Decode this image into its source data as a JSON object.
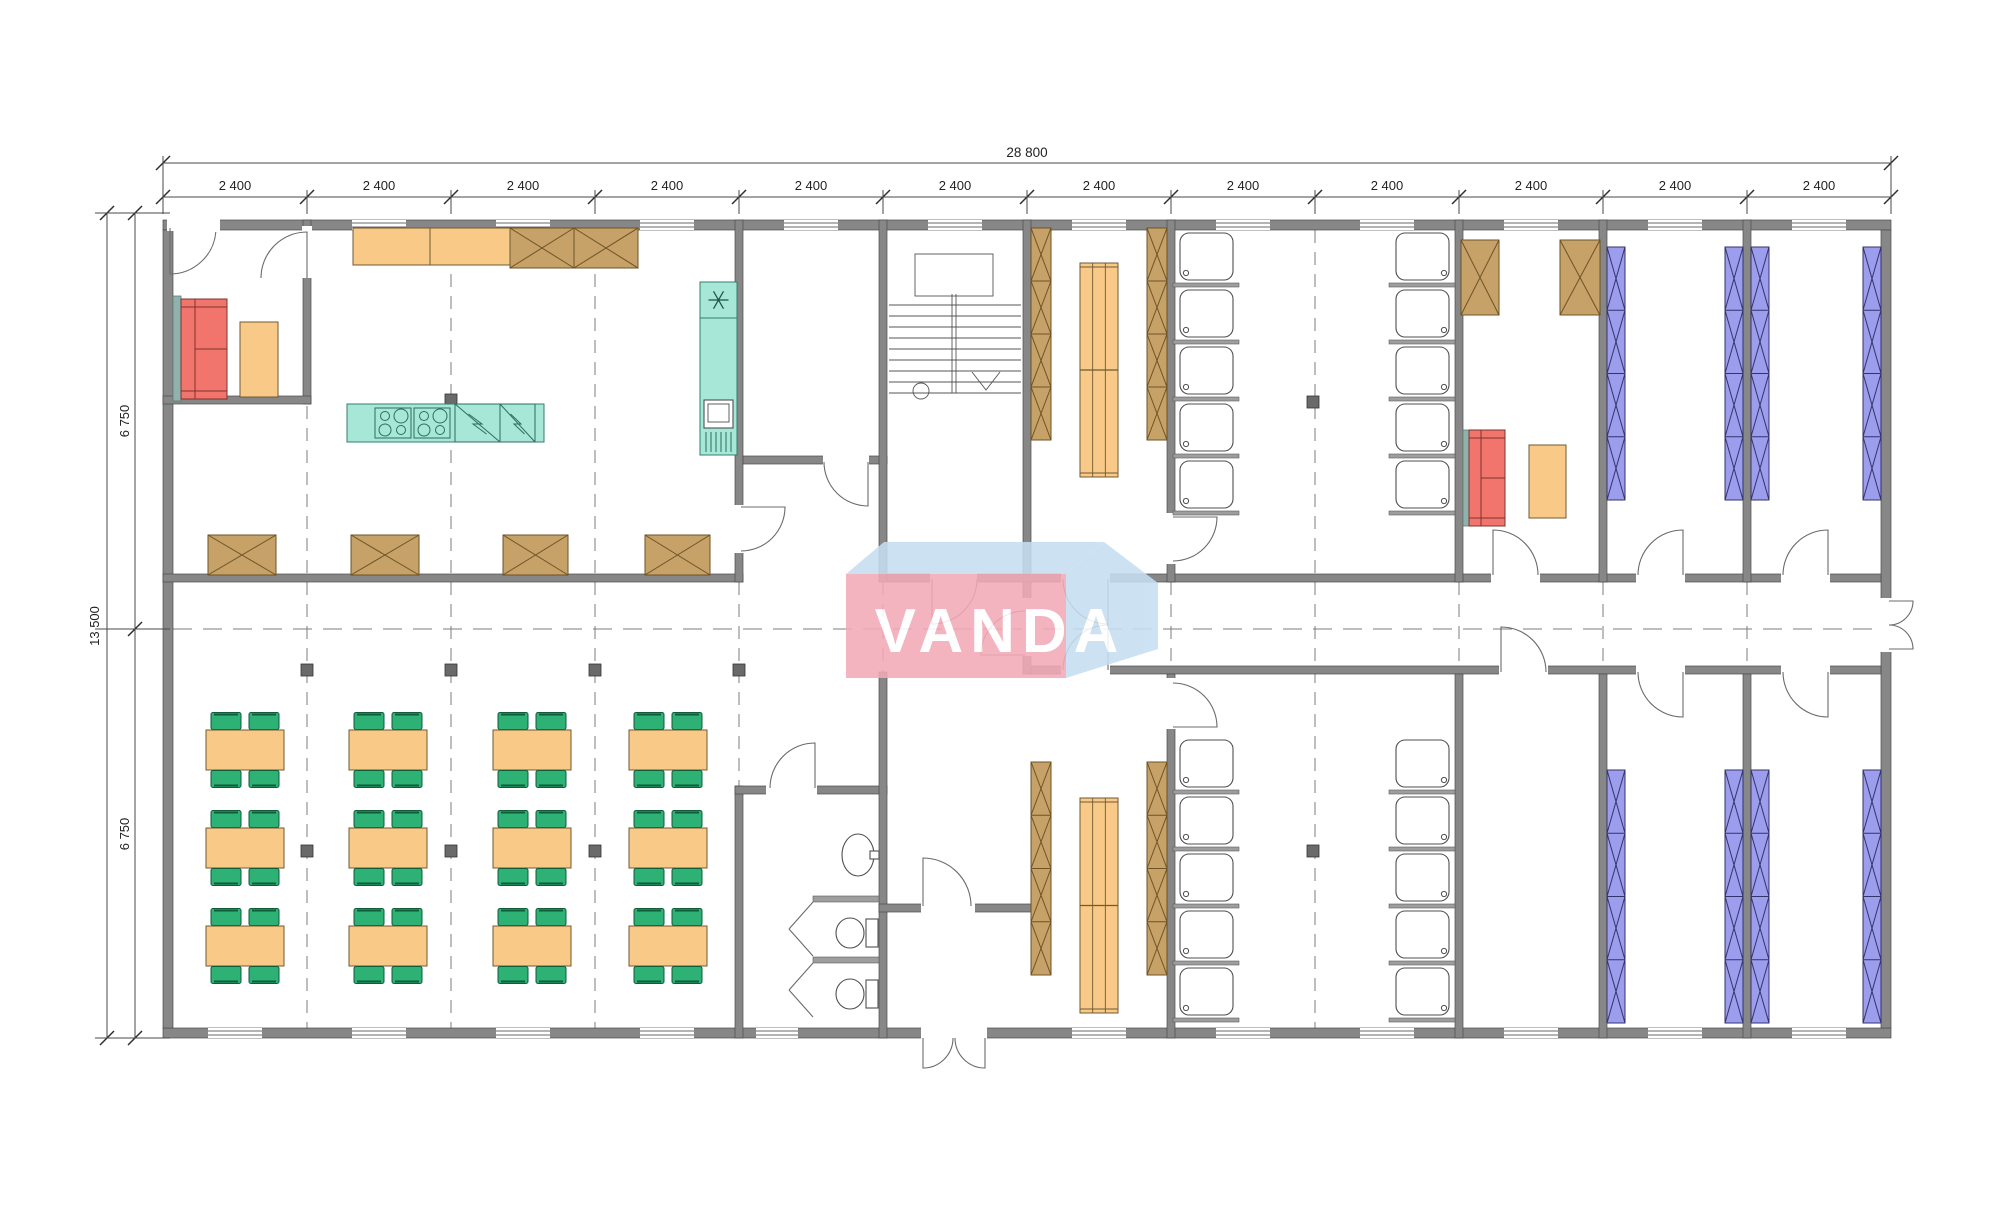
{
  "watermark": {
    "text": "VANDA"
  },
  "dimensions": {
    "top_total": "28 800",
    "module": "2 400",
    "module_count": 12,
    "left_total": "13 500",
    "left_half": "6 750"
  },
  "colors": {
    "wall": "#878787",
    "wallStroke": "#4a4a4a",
    "partition": "#9e9e9e",
    "grid": "#7d7d7d",
    "orange": "#f8c987",
    "orangeStroke": "#6f5a34",
    "green": "#2db175",
    "greenStroke": "#0e5c38",
    "tan": "#c6a168",
    "tanStroke": "#6e5325",
    "teal": "#a6e7d7",
    "tealStroke": "#357e6c",
    "red": "#f1746d",
    "redStroke": "#7e342f",
    "purple": "#9d9dee",
    "purpleStroke": "#33336a",
    "column": "#6a6a6a",
    "sofaBack": "#8fb2ac",
    "logoPink": "#f3aab7",
    "logoBlue": "#c6def0",
    "logoText": "#ffffff"
  },
  "plan": {
    "canvas": {
      "w": 2000,
      "h": 1216
    },
    "grid": {
      "x0": 163,
      "x1": 1891,
      "yTop": 220,
      "yBottom": 1038,
      "module": 144,
      "axisY": 629
    },
    "boundaries": [
      163,
      307,
      451,
      595,
      739,
      883,
      1027,
      1171,
      1315,
      1459,
      1603,
      1747,
      1891
    ],
    "gridLinesFull": [
      307,
      451,
      595,
      739,
      1315
    ],
    "gridStubs": [
      883,
      1171,
      1459,
      1603,
      1747
    ],
    "walls": [
      [
        163,
        220,
        1728,
        10
      ],
      [
        163,
        1028,
        1728,
        10
      ],
      [
        163,
        230,
        10,
        798
      ],
      [
        1881,
        230,
        10,
        798
      ],
      [
        303,
        220,
        8,
        184
      ],
      [
        163,
        396,
        148,
        8
      ],
      [
        163,
        574,
        580,
        8
      ],
      [
        735,
        220,
        8,
        362
      ],
      [
        743,
        456,
        144,
        8
      ],
      [
        735,
        786,
        8,
        252
      ],
      [
        735,
        786,
        152,
        8
      ],
      [
        879,
        220,
        8,
        362
      ],
      [
        879,
        672,
        8,
        366
      ],
      [
        1023,
        220,
        8,
        362
      ],
      [
        1023,
        574,
        8,
        100
      ],
      [
        879,
        904,
        152,
        8
      ],
      [
        887,
        574,
        994,
        8
      ],
      [
        1031,
        666,
        850,
        8
      ],
      [
        1167,
        220,
        8,
        362
      ],
      [
        1455,
        220,
        8,
        362
      ],
      [
        1599,
        220,
        8,
        362
      ],
      [
        1743,
        220,
        8,
        362
      ],
      [
        1167,
        674,
        8,
        364
      ],
      [
        1455,
        674,
        8,
        364
      ],
      [
        1599,
        674,
        8,
        364
      ],
      [
        1743,
        674,
        8,
        364
      ]
    ],
    "gaps": [
      [
        167,
        219,
        53,
        12
      ],
      [
        302,
        226,
        10,
        52
      ],
      [
        734,
        505,
        10,
        48
      ],
      [
        823,
        455,
        46,
        10
      ],
      [
        930,
        573,
        47,
        10
      ],
      [
        1022,
        598,
        10,
        58
      ],
      [
        1061,
        573,
        49,
        10
      ],
      [
        1166,
        513,
        10,
        51
      ],
      [
        1491,
        573,
        49,
        10
      ],
      [
        1636,
        573,
        49,
        10
      ],
      [
        1781,
        573,
        49,
        10
      ],
      [
        1061,
        665,
        49,
        10
      ],
      [
        1166,
        678,
        10,
        51
      ],
      [
        1499,
        665,
        49,
        10
      ],
      [
        1636,
        665,
        49,
        10
      ],
      [
        1781,
        665,
        49,
        10
      ],
      [
        766,
        785,
        51,
        10
      ],
      [
        921,
        903,
        54,
        10
      ],
      [
        921,
        1027,
        66,
        12
      ],
      [
        1880,
        598,
        12,
        54
      ]
    ],
    "partitions": [
      [
        813,
        896,
        66,
        6
      ],
      [
        813,
        957,
        66,
        6
      ]
    ],
    "windowsTop": [
      [
        379,
        54
      ],
      [
        523,
        54
      ],
      [
        667,
        54
      ],
      [
        811,
        54
      ],
      [
        955,
        54
      ],
      [
        1099,
        54
      ],
      [
        1243,
        54
      ],
      [
        1387,
        54
      ],
      [
        1531,
        54
      ],
      [
        1675,
        54
      ],
      [
        1819,
        54
      ]
    ],
    "windowsBottom": [
      [
        235,
        54
      ],
      [
        379,
        54
      ],
      [
        523,
        54
      ],
      [
        667,
        54
      ],
      [
        777,
        42
      ],
      [
        1099,
        54
      ],
      [
        1243,
        54
      ],
      [
        1387,
        54
      ],
      [
        1531,
        54
      ],
      [
        1675,
        54
      ],
      [
        1819,
        54
      ]
    ],
    "doors": [
      [
        170,
        228,
        46,
        90,
        5
      ],
      [
        307,
        278,
        46,
        270,
        180
      ],
      [
        741,
        507,
        44,
        0,
        90
      ],
      [
        868,
        462,
        44,
        90,
        180
      ],
      [
        932,
        579,
        45,
        90,
        0
      ],
      [
        1025,
        655,
        44,
        180,
        270
      ],
      [
        1108,
        579,
        45,
        90,
        180
      ],
      [
        1173,
        517,
        44,
        0,
        90
      ],
      [
        1493,
        575,
        45,
        270,
        0
      ],
      [
        1683,
        575,
        45,
        270,
        180
      ],
      [
        1828,
        575,
        45,
        270,
        180
      ],
      [
        1108,
        670,
        45,
        270,
        180
      ],
      [
        1173,
        727,
        44,
        0,
        270
      ],
      [
        1501,
        672,
        45,
        270,
        0
      ],
      [
        1683,
        672,
        45,
        90,
        180
      ],
      [
        1828,
        672,
        45,
        90,
        180
      ],
      [
        815,
        788,
        45,
        270,
        180
      ],
      [
        923,
        906,
        48,
        270,
        0
      ],
      [
        923,
        1038,
        30,
        90,
        0
      ],
      [
        985,
        1038,
        30,
        90,
        180
      ],
      [
        1889,
        601,
        24,
        0,
        90
      ],
      [
        1889,
        649,
        24,
        0,
        270
      ]
    ],
    "stallDoors": [
      [
        813,
        902,
        789,
        929,
        813,
        956
      ],
      [
        813,
        963,
        789,
        990,
        813,
        1017
      ]
    ],
    "columns": [
      [
        451,
        400
      ],
      [
        1313,
        402
      ],
      [
        307,
        670
      ],
      [
        451,
        670
      ],
      [
        595,
        670
      ],
      [
        739,
        670
      ],
      [
        307,
        851
      ],
      [
        451,
        851
      ],
      [
        595,
        851
      ],
      [
        1313,
        851
      ]
    ],
    "stairs": {
      "x0": 889,
      "x1": 1021,
      "landing": [
        915,
        254,
        78,
        42
      ],
      "treadsY": [
        305,
        316,
        327,
        338,
        349,
        360,
        371,
        382,
        393
      ],
      "divX": 954,
      "divY0": 294,
      "divY1": 393,
      "circle": [
        921,
        391,
        8
      ],
      "arrow": [
        [
          972,
          372
        ],
        [
          986,
          390
        ],
        [
          1000,
          372
        ]
      ]
    },
    "furniture": {
      "tables": [
        [
          245,
          750
        ],
        [
          388,
          750
        ],
        [
          532,
          750
        ],
        [
          668,
          750
        ],
        [
          245,
          848
        ],
        [
          388,
          848
        ],
        [
          532,
          848
        ],
        [
          668,
          848
        ],
        [
          245,
          946
        ],
        [
          388,
          946
        ],
        [
          532,
          946
        ],
        [
          668,
          946
        ]
      ],
      "tableSize": [
        78,
        40
      ],
      "wardrobes": [
        [
          208,
          535,
          68,
          40
        ],
        [
          351,
          535,
          68,
          40
        ],
        [
          503,
          535,
          65,
          40
        ],
        [
          645,
          535,
          65,
          40
        ],
        [
          510,
          228,
          64,
          40
        ],
        [
          574,
          228,
          64,
          40
        ],
        [
          1461,
          240,
          38,
          75
        ],
        [
          1560,
          240,
          40,
          75
        ]
      ],
      "counter": {
        "rect": [
          353,
          228,
          157,
          37
        ],
        "dividerX": 430
      },
      "island": {
        "rect": [
          347,
          404,
          197,
          38
        ],
        "stoves": [
          [
            375,
            408
          ],
          [
            414,
            408
          ]
        ],
        "stoveSize": [
          36,
          30
        ],
        "dishwashers": [
          [
            455,
            404,
            45,
            38
          ],
          [
            500,
            404,
            35,
            38
          ]
        ]
      },
      "fridge": {
        "rect": [
          700,
          282,
          37,
          173
        ],
        "snowCell": 36,
        "applianceY": 400
      },
      "lockers": [
        [
          1031,
          228,
          20,
          212
        ],
        [
          1147,
          228,
          20,
          212
        ],
        [
          1031,
          762,
          20,
          213
        ],
        [
          1147,
          762,
          20,
          213
        ]
      ],
      "benches": [
        [
          1080,
          263,
          38,
          214
        ],
        [
          1080,
          798,
          38,
          215
        ]
      ],
      "showerCols": [
        {
          "x": 1175,
          "y": 228,
          "side": "left"
        },
        {
          "x": 1391,
          "y": 228,
          "side": "right"
        },
        {
          "x": 1175,
          "y": 735,
          "side": "left"
        },
        {
          "x": 1391,
          "y": 735,
          "side": "right"
        }
      ],
      "showerUnit": {
        "w": 64,
        "h": 57,
        "n": 5
      },
      "bunks": [
        [
          1607,
          247
        ],
        [
          1725,
          247
        ],
        [
          1751,
          247
        ],
        [
          1863,
          247
        ],
        [
          1607,
          770
        ],
        [
          1725,
          770
        ],
        [
          1751,
          770
        ],
        [
          1863,
          770
        ]
      ],
      "bunkSize": [
        18,
        253
      ],
      "sofas": [
        {
          "strip": [
            173,
            296,
            8,
            105
          ],
          "body": [
            181,
            299,
            46,
            100
          ],
          "backX": 195,
          "midY": 349
        },
        {
          "strip": [
            1463,
            430,
            6,
            96
          ],
          "body": [
            1469,
            430,
            36,
            96
          ],
          "backX": 1481,
          "midY": 478
        }
      ],
      "sideTables": [
        [
          240,
          322,
          38,
          75
        ],
        [
          1529,
          445,
          37,
          73
        ]
      ],
      "toilets": [
        {
          "cx": 850,
          "cy": 933
        },
        {
          "cx": 850,
          "cy": 994
        }
      ],
      "basin": {
        "cx": 858,
        "cy": 855,
        "rx": 16,
        "ry": 21
      }
    },
    "dims": {
      "topTotalY": 163,
      "topModuleY": 197,
      "leftOuterX": 107,
      "leftInnerX": 135,
      "extTop": [
        [
          163,
          156
        ],
        [
          1891,
          156
        ]
      ],
      "leftExtY": [
        213,
        629,
        1038
      ]
    }
  }
}
